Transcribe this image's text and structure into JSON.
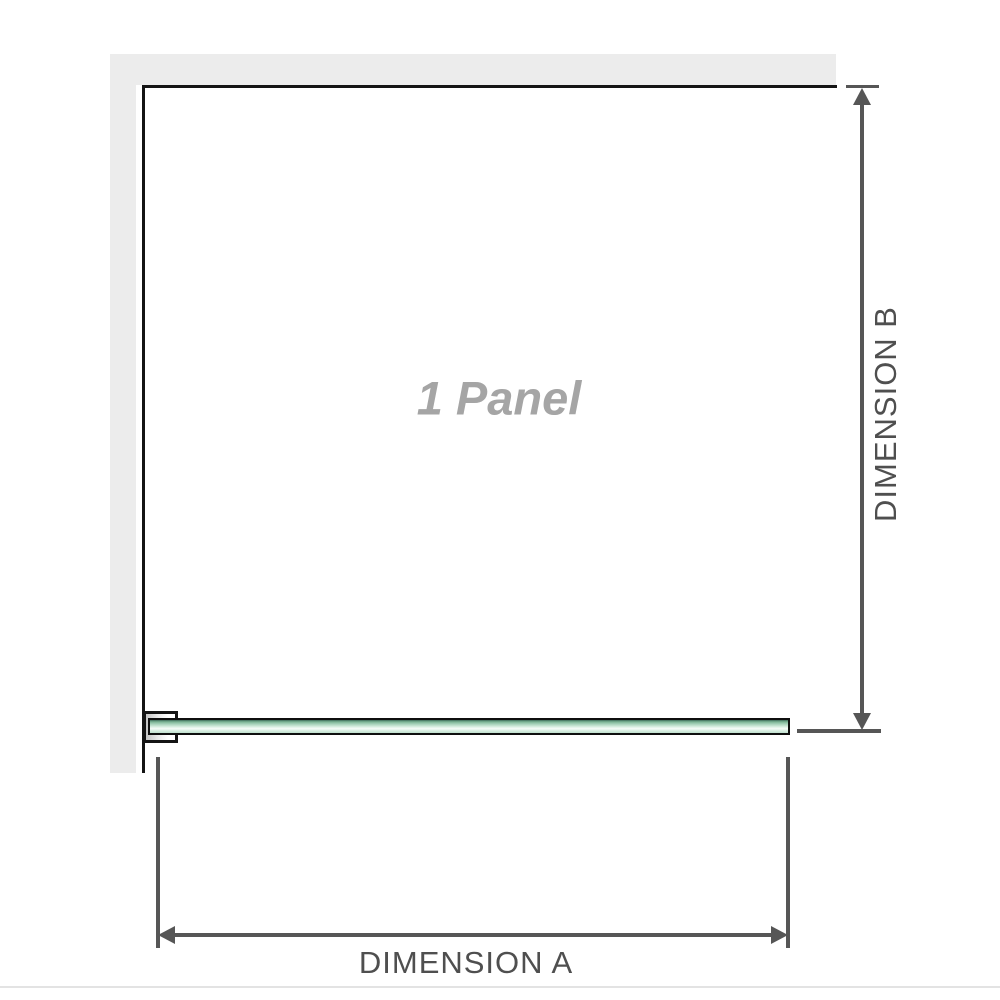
{
  "diagram": {
    "title": "Shower screen panel dimension diagram",
    "panel_label": "1 Panel",
    "dimension_a_label": "DIMENSION A",
    "dimension_b_label": "DIMENSION B",
    "colors": {
      "wall_fill": "#ececec",
      "panel_outline": "#141414",
      "dimension_line": "#565656",
      "dimension_text": "#4f4f4f",
      "watermark_text": "#a5a5a5",
      "glass_dark_green": "#3c6b57",
      "glass_mid_green": "#a8d3bb",
      "glass_highlight": "#f7fcf9",
      "bracket_shadow": "#c4c4c4",
      "page_rule": "#e3e3e3"
    }
  }
}
